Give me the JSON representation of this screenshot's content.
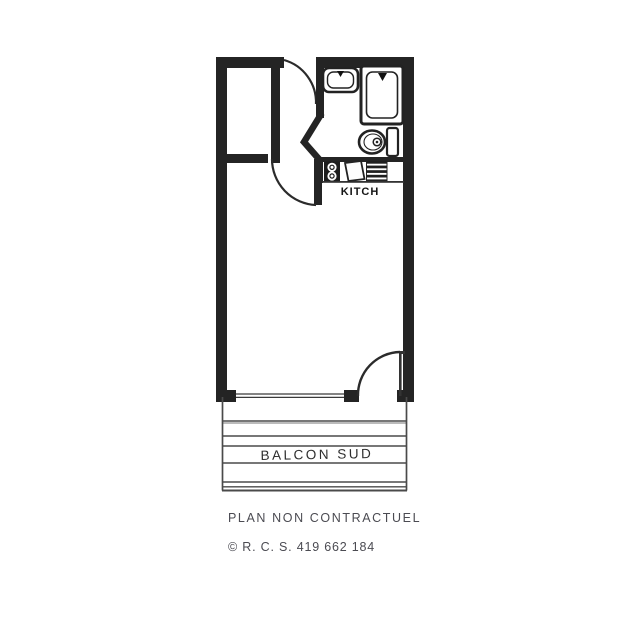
{
  "page": {
    "background": "#ffffff"
  },
  "plan": {
    "type": "apartment-floor-plan",
    "ink_color": "#242424",
    "railing_color": "#4a4a4a",
    "labels": {
      "kitchen": "KITCH",
      "balcony": "BALCON SUD"
    },
    "fixtures": [
      "washbasin",
      "shower",
      "toilet",
      "hob-burners",
      "kitchen-sink",
      "hatched-appliance",
      "closet"
    ],
    "doors": [
      "entrance-door",
      "hall-door",
      "balcony-door"
    ]
  },
  "captions": {
    "disclaimer": "PLAN NON CONTRACTUEL",
    "registration": "© R. C. S. 419 662 184",
    "color": "#4b4b52"
  }
}
